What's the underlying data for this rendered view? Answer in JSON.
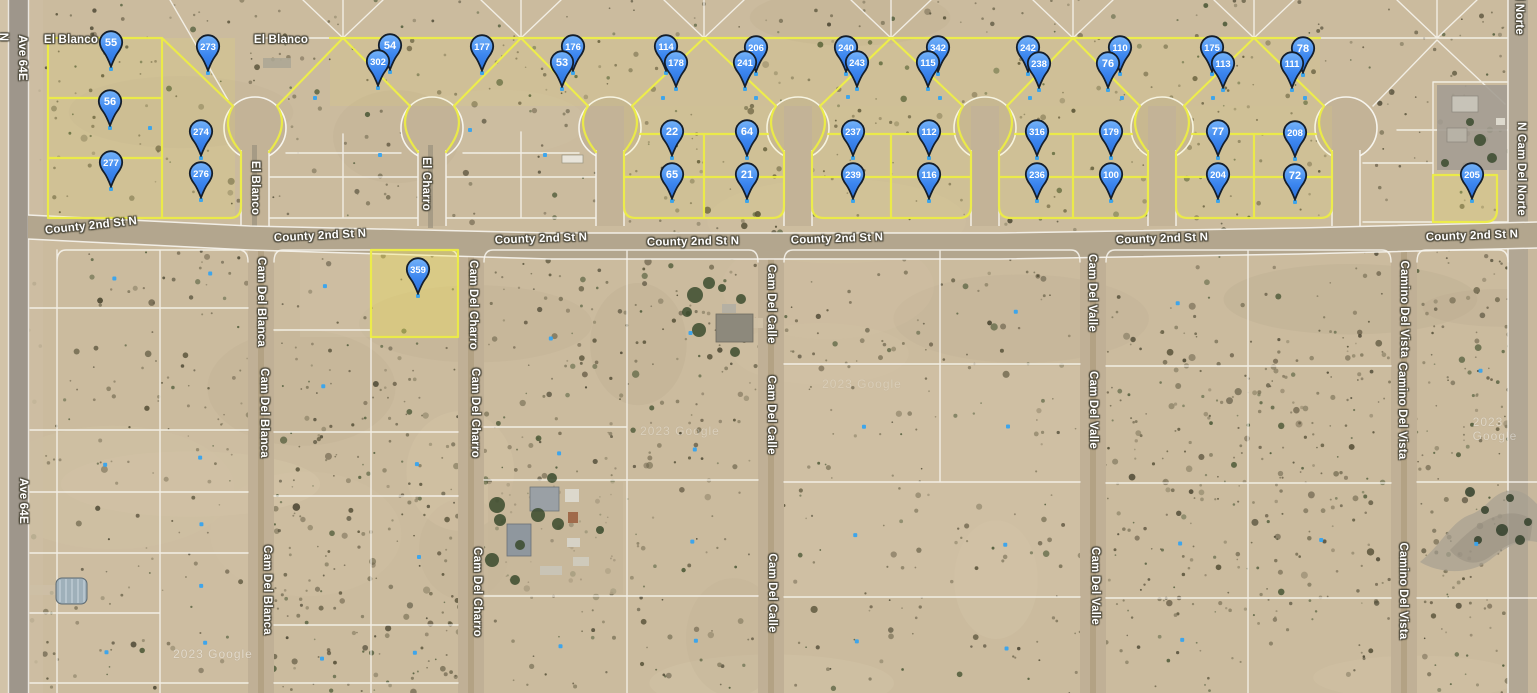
{
  "map": {
    "attribution": "2023 Google",
    "colors": {
      "terrain": "#cbbb9e",
      "parcel_yellow": "#ecec45",
      "line_white": "#f7f5ee",
      "asphalt": "#9e968b",
      "dirt_road": "#c0b096",
      "county_road": "#b3a68e",
      "pin_fill_top": "#6fb0f8",
      "pin_fill_bottom": "#2e78e8",
      "pin_stroke": "#141e2b",
      "blue_dot": "#36a3ef"
    },
    "pins": [
      {
        "label": "55",
        "x": 111,
        "y": 42
      },
      {
        "label": "273",
        "x": 208,
        "y": 46
      },
      {
        "label": "56",
        "x": 110,
        "y": 101
      },
      {
        "label": "274",
        "x": 201,
        "y": 131
      },
      {
        "label": "277",
        "x": 111,
        "y": 162
      },
      {
        "label": "276",
        "x": 201,
        "y": 173
      },
      {
        "label": "54",
        "x": 390,
        "y": 45
      },
      {
        "label": "302",
        "x": 378,
        "y": 61
      },
      {
        "label": "177",
        "x": 482,
        "y": 46
      },
      {
        "label": "176",
        "x": 573,
        "y": 46
      },
      {
        "label": "53",
        "x": 562,
        "y": 62
      },
      {
        "label": "114",
        "x": 666,
        "y": 46
      },
      {
        "label": "178",
        "x": 676,
        "y": 62
      },
      {
        "label": "206",
        "x": 756,
        "y": 47
      },
      {
        "label": "241",
        "x": 745,
        "y": 62
      },
      {
        "label": "240",
        "x": 846,
        "y": 47
      },
      {
        "label": "243",
        "x": 857,
        "y": 62
      },
      {
        "label": "342",
        "x": 938,
        "y": 47
      },
      {
        "label": "115",
        "x": 928,
        "y": 62
      },
      {
        "label": "242",
        "x": 1028,
        "y": 47
      },
      {
        "label": "238",
        "x": 1039,
        "y": 63
      },
      {
        "label": "110",
        "x": 1120,
        "y": 47
      },
      {
        "label": "76",
        "x": 1108,
        "y": 63
      },
      {
        "label": "175",
        "x": 1212,
        "y": 47
      },
      {
        "label": "113",
        "x": 1223,
        "y": 63
      },
      {
        "label": "78",
        "x": 1303,
        "y": 48
      },
      {
        "label": "111",
        "x": 1292,
        "y": 63
      },
      {
        "label": "22",
        "x": 672,
        "y": 131
      },
      {
        "label": "64",
        "x": 747,
        "y": 131
      },
      {
        "label": "237",
        "x": 853,
        "y": 131
      },
      {
        "label": "112",
        "x": 929,
        "y": 131
      },
      {
        "label": "316",
        "x": 1037,
        "y": 131
      },
      {
        "label": "179",
        "x": 1111,
        "y": 131
      },
      {
        "label": "77",
        "x": 1218,
        "y": 131
      },
      {
        "label": "208",
        "x": 1295,
        "y": 132
      },
      {
        "label": "65",
        "x": 672,
        "y": 174
      },
      {
        "label": "21",
        "x": 747,
        "y": 174
      },
      {
        "label": "239",
        "x": 853,
        "y": 174
      },
      {
        "label": "116",
        "x": 929,
        "y": 174
      },
      {
        "label": "236",
        "x": 1037,
        "y": 174
      },
      {
        "label": "100",
        "x": 1111,
        "y": 174
      },
      {
        "label": "204",
        "x": 1218,
        "y": 174
      },
      {
        "label": "72",
        "x": 1295,
        "y": 175
      },
      {
        "label": "205",
        "x": 1472,
        "y": 174
      },
      {
        "label": "359",
        "x": 418,
        "y": 269
      }
    ],
    "horizontal_labels": [
      {
        "text": "El Blanco",
        "x": 71,
        "y": 40,
        "rot": 0
      },
      {
        "text": "El Blanco",
        "x": 281,
        "y": 40,
        "rot": 0
      },
      {
        "text": "County 2nd St N",
        "x": 91,
        "y": 226,
        "rot": -6
      },
      {
        "text": "County 2nd St N",
        "x": 320,
        "y": 236,
        "rot": -3
      },
      {
        "text": "County 2nd St N",
        "x": 541,
        "y": 239,
        "rot": -2
      },
      {
        "text": "County 2nd St N",
        "x": 693,
        "y": 242,
        "rot": -1
      },
      {
        "text": "County 2nd St N",
        "x": 837,
        "y": 239,
        "rot": -2
      },
      {
        "text": "County 2nd St N",
        "x": 1162,
        "y": 239,
        "rot": -2
      },
      {
        "text": "County 2nd St N",
        "x": 1472,
        "y": 236,
        "rot": -2
      }
    ],
    "vertical_labels": [
      {
        "text": "N",
        "x": 3,
        "y": 37
      },
      {
        "text": "Ave 64E",
        "x": 22,
        "y": 58
      },
      {
        "text": "Ave 64E",
        "x": 23,
        "y": 501
      },
      {
        "text": "El Blanco",
        "x": 255,
        "y": 188
      },
      {
        "text": "El Charro",
        "x": 426,
        "y": 184
      },
      {
        "text": "Cam Del Blanca",
        "x": 261,
        "y": 302
      },
      {
        "text": "Cam Del Blanca",
        "x": 264,
        "y": 413
      },
      {
        "text": "Cam Del Blanca",
        "x": 267,
        "y": 590
      },
      {
        "text": "Cam Del Charro",
        "x": 473,
        "y": 305
      },
      {
        "text": "Cam Del Charro",
        "x": 475,
        "y": 413
      },
      {
        "text": "Cam Del Charro",
        "x": 477,
        "y": 592
      },
      {
        "text": "Cam Del Calle",
        "x": 771,
        "y": 304
      },
      {
        "text": "Cam Del Calle",
        "x": 771,
        "y": 415
      },
      {
        "text": "Cam Del Calle",
        "x": 772,
        "y": 593
      },
      {
        "text": "Cam Del Valle",
        "x": 1092,
        "y": 293
      },
      {
        "text": "Cam Del Valle",
        "x": 1093,
        "y": 410
      },
      {
        "text": "Cam Del Valle",
        "x": 1095,
        "y": 586
      },
      {
        "text": "Camino Del Vista",
        "x": 1404,
        "y": 309
      },
      {
        "text": "Camino Del Vista",
        "x": 1402,
        "y": 411
      },
      {
        "text": "Camino Del Vista",
        "x": 1403,
        "y": 591
      },
      {
        "text": "N Cam Del Norte",
        "x": 1521,
        "y": 169
      },
      {
        "text": "N Cam Del Norte",
        "x": 1519,
        "y": -12
      }
    ]
  }
}
